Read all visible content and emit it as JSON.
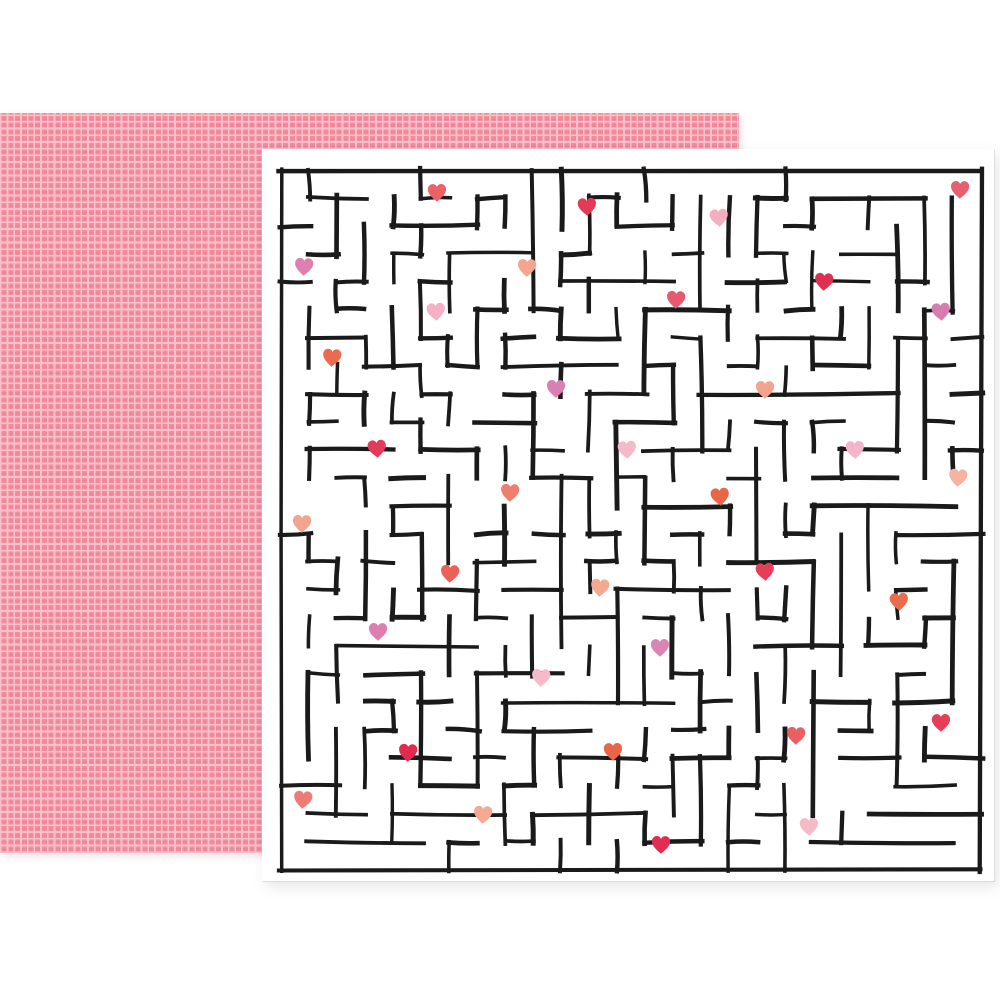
{
  "scene": {
    "background_color": "#ffffff"
  },
  "back_sheet": {
    "base_color": "#f2909f",
    "grid_line_color": "#f8c0ca",
    "grid_inner_square_color": "#ee8799",
    "grid_cell_px": 6.7,
    "grid_line_px": 1.7
  },
  "front_sheet": {
    "background_color": "#ffffff",
    "edge_color": "#dedede"
  },
  "maze": {
    "rows": 25,
    "cols": 25,
    "cell_px": 28,
    "offset_x": 19,
    "offset_y": 21,
    "wall_color": "#1a1a1a",
    "wall_width": 4.1,
    "seed": 20240214,
    "extra_opening_ratio": 0.12
  },
  "hearts": [
    {
      "x": 437,
      "y": 193,
      "color": "#ec6066"
    },
    {
      "x": 587,
      "y": 207,
      "color": "#e43a58"
    },
    {
      "x": 960,
      "y": 190,
      "color": "#e6606f"
    },
    {
      "x": 719,
      "y": 218,
      "color": "#f3aec2"
    },
    {
      "x": 304,
      "y": 267,
      "color": "#df7fae"
    },
    {
      "x": 527,
      "y": 268,
      "color": "#f5a48e"
    },
    {
      "x": 824,
      "y": 282,
      "color": "#e03050"
    },
    {
      "x": 676,
      "y": 300,
      "color": "#e75a6e"
    },
    {
      "x": 436,
      "y": 312,
      "color": "#f5b0c4"
    },
    {
      "x": 941,
      "y": 312,
      "color": "#d87cb0"
    },
    {
      "x": 332,
      "y": 358,
      "color": "#ec6a50"
    },
    {
      "x": 556,
      "y": 389,
      "color": "#d980b2"
    },
    {
      "x": 765,
      "y": 390,
      "color": "#f3a48e"
    },
    {
      "x": 377,
      "y": 449,
      "color": "#e23a58"
    },
    {
      "x": 627,
      "y": 450,
      "color": "#f5bac9"
    },
    {
      "x": 855,
      "y": 450,
      "color": "#f5b5c8"
    },
    {
      "x": 958,
      "y": 478,
      "color": "#f6b3a1"
    },
    {
      "x": 510,
      "y": 493,
      "color": "#ef7e6d"
    },
    {
      "x": 720,
      "y": 497,
      "color": "#ea6448"
    },
    {
      "x": 302,
      "y": 524,
      "color": "#f3a48e"
    },
    {
      "x": 765,
      "y": 572,
      "color": "#e63e56"
    },
    {
      "x": 450,
      "y": 574,
      "color": "#ec6056"
    },
    {
      "x": 600,
      "y": 588,
      "color": "#f4a992"
    },
    {
      "x": 899,
      "y": 602,
      "color": "#eb6c4c"
    },
    {
      "x": 378,
      "y": 632,
      "color": "#de7eb0"
    },
    {
      "x": 660,
      "y": 648,
      "color": "#dc84b4"
    },
    {
      "x": 541,
      "y": 678,
      "color": "#f6bacb"
    },
    {
      "x": 941,
      "y": 723,
      "color": "#e63e56"
    },
    {
      "x": 796,
      "y": 736,
      "color": "#ea6060"
    },
    {
      "x": 408,
      "y": 753,
      "color": "#e22a50"
    },
    {
      "x": 613,
      "y": 752,
      "color": "#ec6448"
    },
    {
      "x": 303,
      "y": 800,
      "color": "#ee7b74"
    },
    {
      "x": 483,
      "y": 815,
      "color": "#f4a992"
    },
    {
      "x": 809,
      "y": 827,
      "color": "#f4bac6"
    },
    {
      "x": 661,
      "y": 845,
      "color": "#e22c52"
    }
  ]
}
